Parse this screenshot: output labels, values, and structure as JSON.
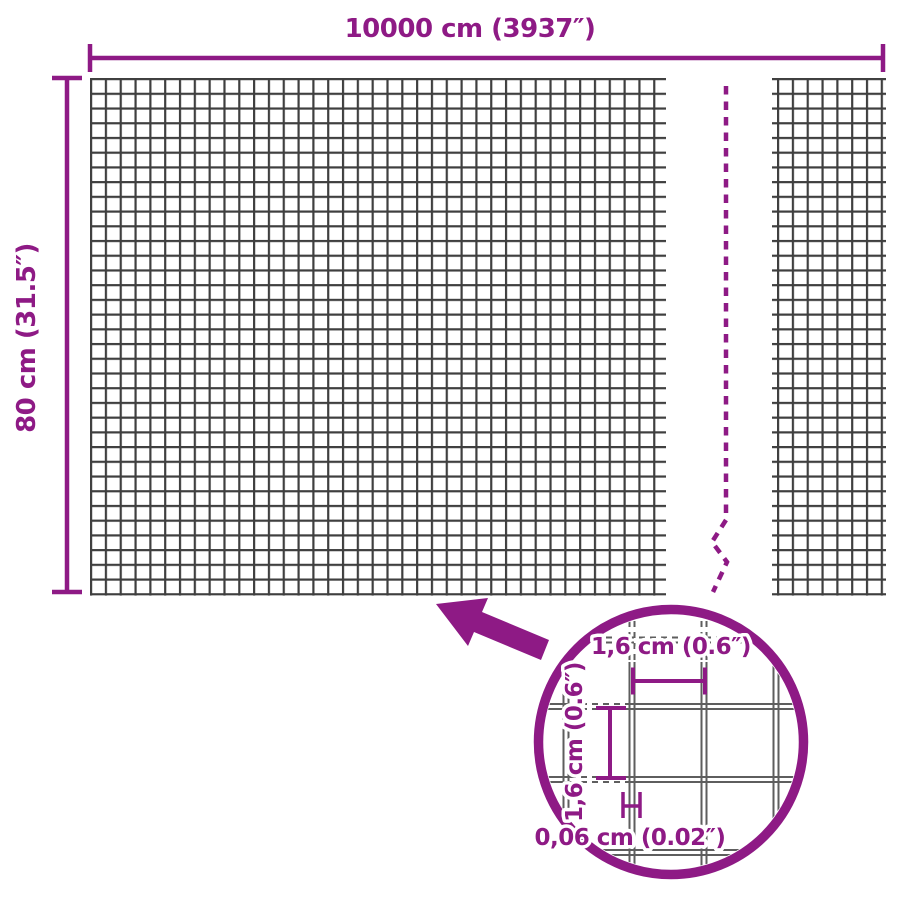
{
  "colors": {
    "accent": "#8E1A85",
    "mesh": "#3F3F3F",
    "wire": "#5E5E5E",
    "bg": "#FFFFFF"
  },
  "dimensions": {
    "width_label": "10000 cm (3937″)",
    "height_label": "80 cm (31.5″)"
  },
  "detail": {
    "mesh_width_label": "1,6 cm (0.6″)",
    "mesh_height_label": "1,6 cm (0.6″)",
    "wire_thickness_label": "0,06 cm (0.02″)"
  }
}
